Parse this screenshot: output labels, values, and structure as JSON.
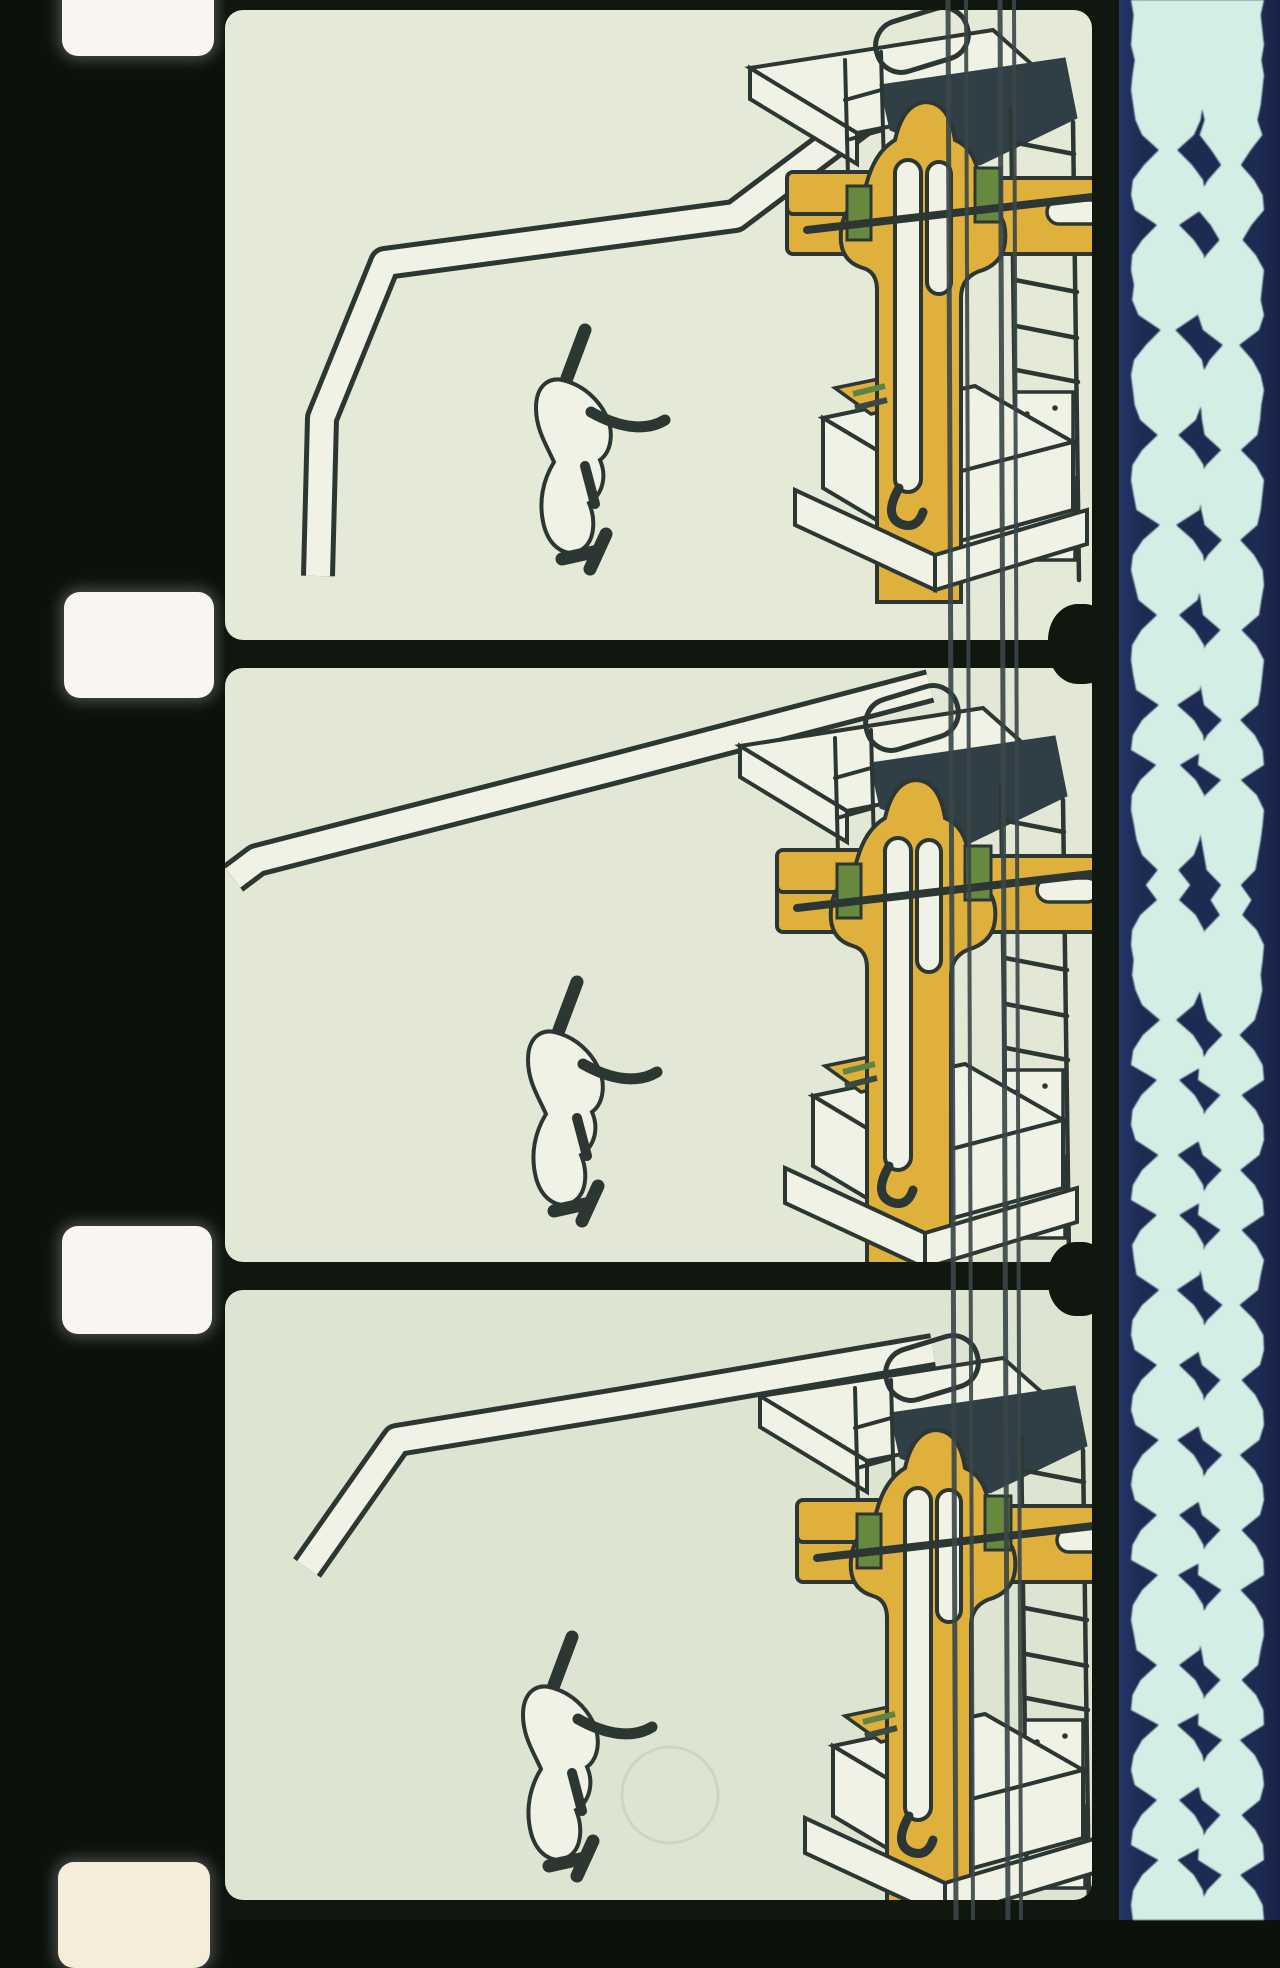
{
  "scene": {
    "kind": "16mm film strip scan",
    "frames_count": 3,
    "perforations_count": 4,
    "soundtrack_kind": "dual bilateral variable-area optical track"
  },
  "colors": {
    "edge": "#0c110b",
    "gutter": "#10170e",
    "hole": "#f9f6f1",
    "hole_warm": "#f5edda",
    "paper": "#f0f2e5",
    "ink": "#2c3733",
    "darkmass": "#303e46",
    "yellow": "#dfb13c",
    "green": "#66883f",
    "navy": "#1d2a51",
    "cyan": "#d2eee5",
    "rail": "#3a4648",
    "frame1_bg": "#e5e9d7",
    "frame2_bg": "#e2e8d5",
    "frame3_bg": "#dde5d2",
    "scratch": "#ccd6c2"
  },
  "perforations": [
    {
      "x": 62,
      "y": -52,
      "w": 152,
      "h": 108,
      "warm": false
    },
    {
      "x": 64,
      "y": 592,
      "w": 150,
      "h": 106,
      "warm": false
    },
    {
      "x": 62,
      "y": 1226,
      "w": 150,
      "h": 108,
      "warm": false
    },
    {
      "x": 58,
      "y": 1862,
      "w": 152,
      "h": 106,
      "warm": true
    }
  ],
  "frames": [
    {
      "top": 10,
      "height": 630,
      "bg": "frame1_bg",
      "machine_dx": 10,
      "machine_dy": -20,
      "word_dx": 8,
      "word_dy": 6,
      "pipe": "M93,566 L97,408 L160,253 L510,206 L700,63"
    },
    {
      "top": 668,
      "height": 594,
      "bg": "frame2_bg",
      "machine_dx": 0,
      "machine_dy": 0,
      "word_dx": 0,
      "word_dy": 0,
      "pipe": "M8,210 L32,192 L395,99 L705,18"
    },
    {
      "top": 1290,
      "height": 610,
      "bg": "frame3_bg",
      "machine_dx": 20,
      "machine_dy": 28,
      "word_dx": -5,
      "word_dy": 33,
      "pipe": "M82,278 L172,150 L398,113 L708,60"
    }
  ],
  "boundary_blobs": [
    {
      "x": 823,
      "y": 604,
      "w": 66,
      "h": 80
    },
    {
      "x": 823,
      "y": 1242,
      "w": 62,
      "h": 74
    }
  ],
  "rails": [
    {
      "x_top": 723,
      "x_bottom": 731,
      "width": 5
    },
    {
      "x_top": 741,
      "x_bottom": 748,
      "width": 4
    },
    {
      "x_top": 775,
      "x_bottom": 783,
      "width": 5
    },
    {
      "x_top": 789,
      "x_bottom": 796,
      "width": 4
    }
  ],
  "soundtrack": {
    "sample_step": 15,
    "tracks": [
      {
        "center": 49,
        "half_width": 37,
        "envelope": [
          1,
          0.93,
          0.97,
          1,
          0.9,
          0.96,
          1,
          0.94,
          0.88,
          0.7,
          0.25,
          0.65,
          0.95,
          1,
          0.9,
          0.3,
          0.7,
          0.97,
          1,
          0.92,
          0.97,
          0.8,
          0.2,
          0.6,
          0.92,
          1,
          0.95,
          0.9,
          0.75,
          0.28,
          0.7,
          0.96,
          1,
          0.93,
          0.85,
          0.22,
          0.68,
          0.95,
          1,
          0.9,
          0.8,
          0.3,
          0.72,
          0.97,
          1,
          0.94,
          0.86,
          0.25,
          0.7,
          0.95,
          1,
          0.32,
          0.75,
          0.98,
          1,
          0.92,
          0.85,
          0.7,
          0.28,
          0.6,
          0.3,
          0.75,
          0.97,
          1,
          0.93,
          0.97,
          0.88,
          0.7,
          0.22,
          0.68,
          0.94,
          1,
          0.3,
          0.72,
          0.96,
          1,
          0.88,
          0.26,
          0.7,
          0.95,
          1,
          0.3,
          0.74,
          0.97,
          0.92,
          0.85,
          0.24,
          0.7,
          0.96,
          1,
          0.9,
          0.3,
          0.72,
          0.95,
          1,
          0.88,
          0.25,
          0.7,
          0.94,
          1,
          0.9,
          0.3,
          0.73,
          0.96,
          1,
          0.27,
          0.7,
          0.95,
          1,
          0.92,
          0.85,
          0.3,
          0.74,
          0.96,
          1,
          0.25,
          0.7,
          0.93,
          1,
          0.9,
          0.3,
          0.72,
          0.95,
          1,
          0.26,
          0.7,
          0.94,
          1,
          0.95
        ]
      },
      {
        "center": 112,
        "half_width": 33,
        "envelope": [
          1,
          0.9,
          0.95,
          1,
          0.92,
          1,
          0.95,
          0.9,
          0.8,
          0.95,
          0.6,
          0.3,
          0.7,
          0.96,
          1,
          0.62,
          0.35,
          0.75,
          1,
          0.95,
          0.9,
          1,
          0.85,
          0.25,
          0.65,
          0.9,
          1,
          0.92,
          0.88,
          0.8,
          0.3,
          0.75,
          1,
          0.95,
          0.9,
          0.8,
          0.28,
          0.7,
          0.96,
          1,
          0.92,
          0.85,
          0.32,
          0.76,
          1,
          0.95,
          0.9,
          0.82,
          0.28,
          0.72,
          0.96,
          1,
          0.3,
          0.78,
          1,
          0.96,
          0.9,
          0.82,
          0.74,
          0.3,
          0.62,
          0.34,
          0.78,
          1,
          0.96,
          0.9,
          0.95,
          0.85,
          0.72,
          0.26,
          0.7,
          0.96,
          1,
          0.32,
          0.75,
          0.98,
          1,
          0.86,
          0.28,
          0.72,
          0.96,
          1,
          0.32,
          0.76,
          1,
          0.9,
          0.82,
          0.26,
          0.72,
          0.98,
          1,
          0.88,
          0.32,
          0.74,
          0.97,
          1,
          0.86,
          0.27,
          0.72,
          0.96,
          1,
          0.88,
          0.32,
          0.75,
          0.98,
          1,
          0.29,
          0.72,
          0.97,
          1,
          0.9,
          0.82,
          0.32,
          0.76,
          0.98,
          1,
          0.27,
          0.72,
          0.95,
          1,
          0.88,
          0.32,
          0.74,
          0.97,
          1,
          0.28,
          0.72,
          0.96,
          1
        ]
      }
    ]
  }
}
